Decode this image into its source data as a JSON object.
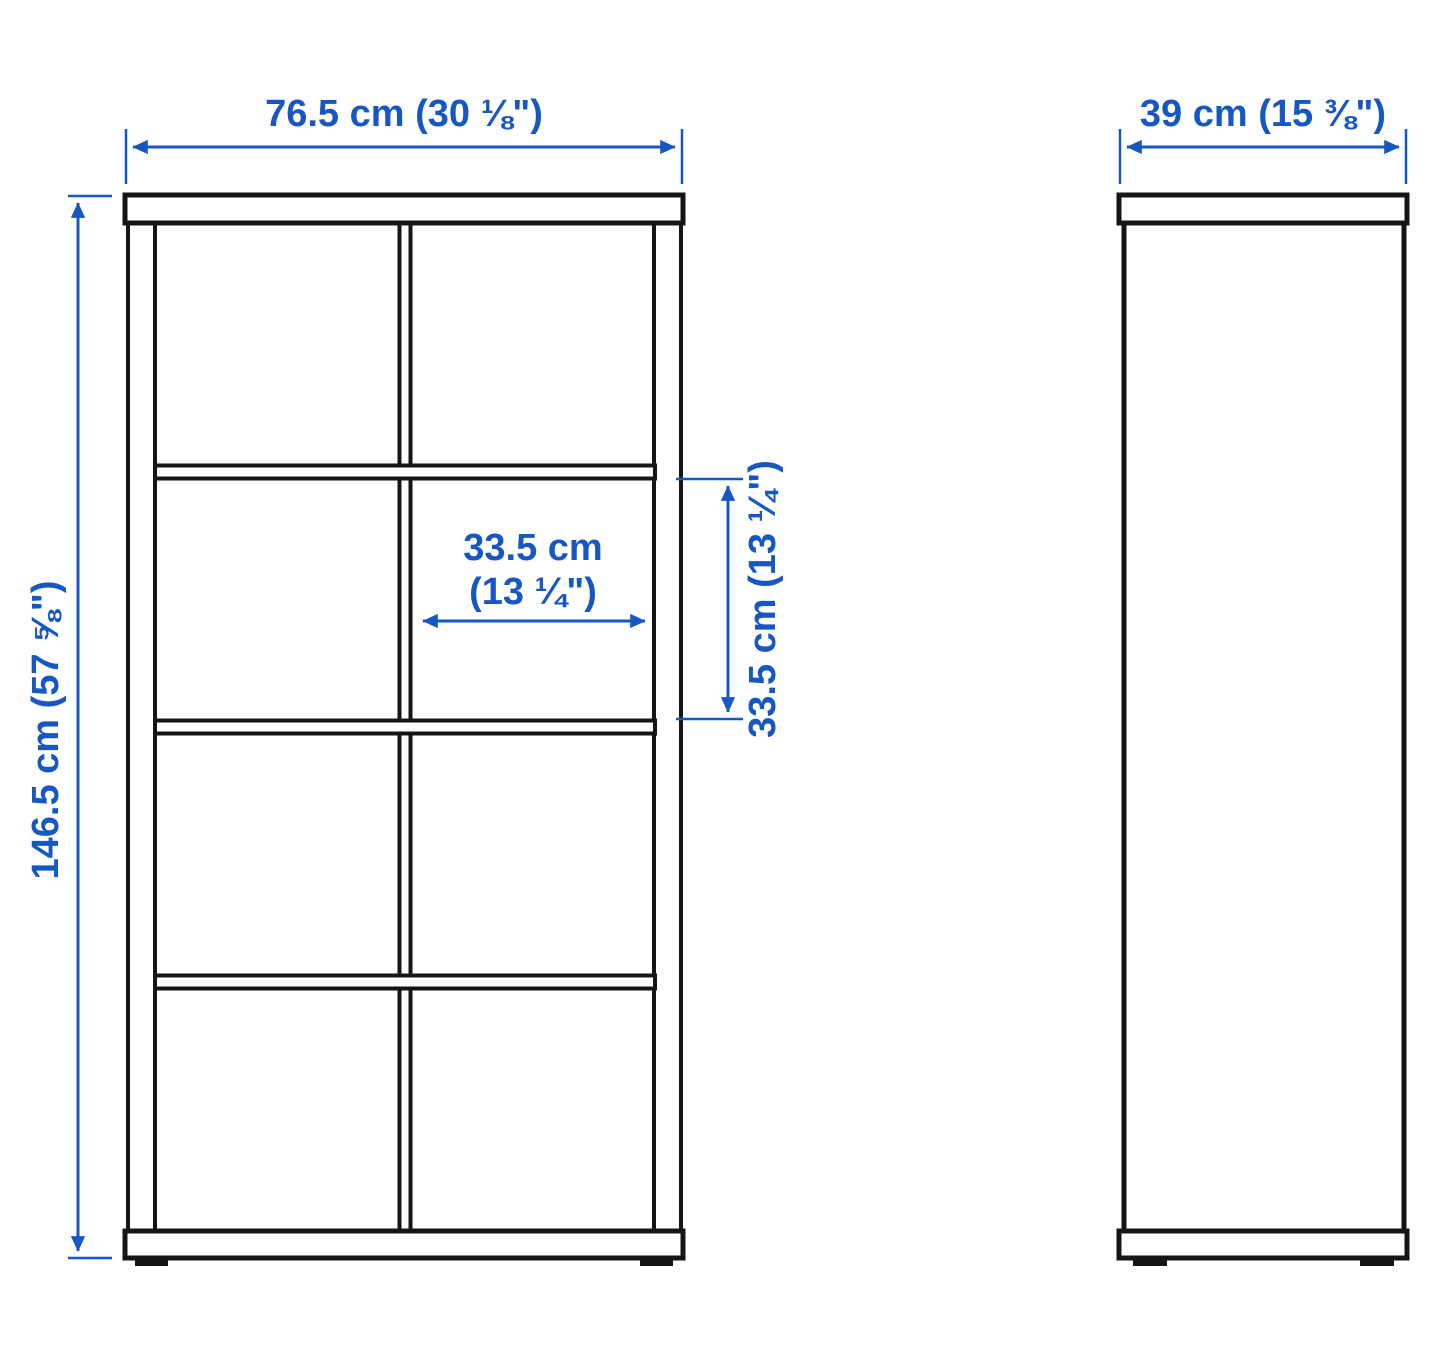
{
  "colors": {
    "dimension_accent": "#1757c4",
    "outline": "#151515",
    "background": "#ffffff"
  },
  "front_view": {
    "width_label": "76.5 cm (30 ⅛\")",
    "height_label": "146.5 cm (57 ⅝\")",
    "cell_width_label_line1": "33.5 cm",
    "cell_width_label_line2": "(13 ¼\")",
    "cell_height_label": "33.5 cm (13 ¼\")",
    "columns": 2,
    "rows": 4
  },
  "side_view": {
    "depth_label": "39 cm (15 ⅜\")"
  }
}
